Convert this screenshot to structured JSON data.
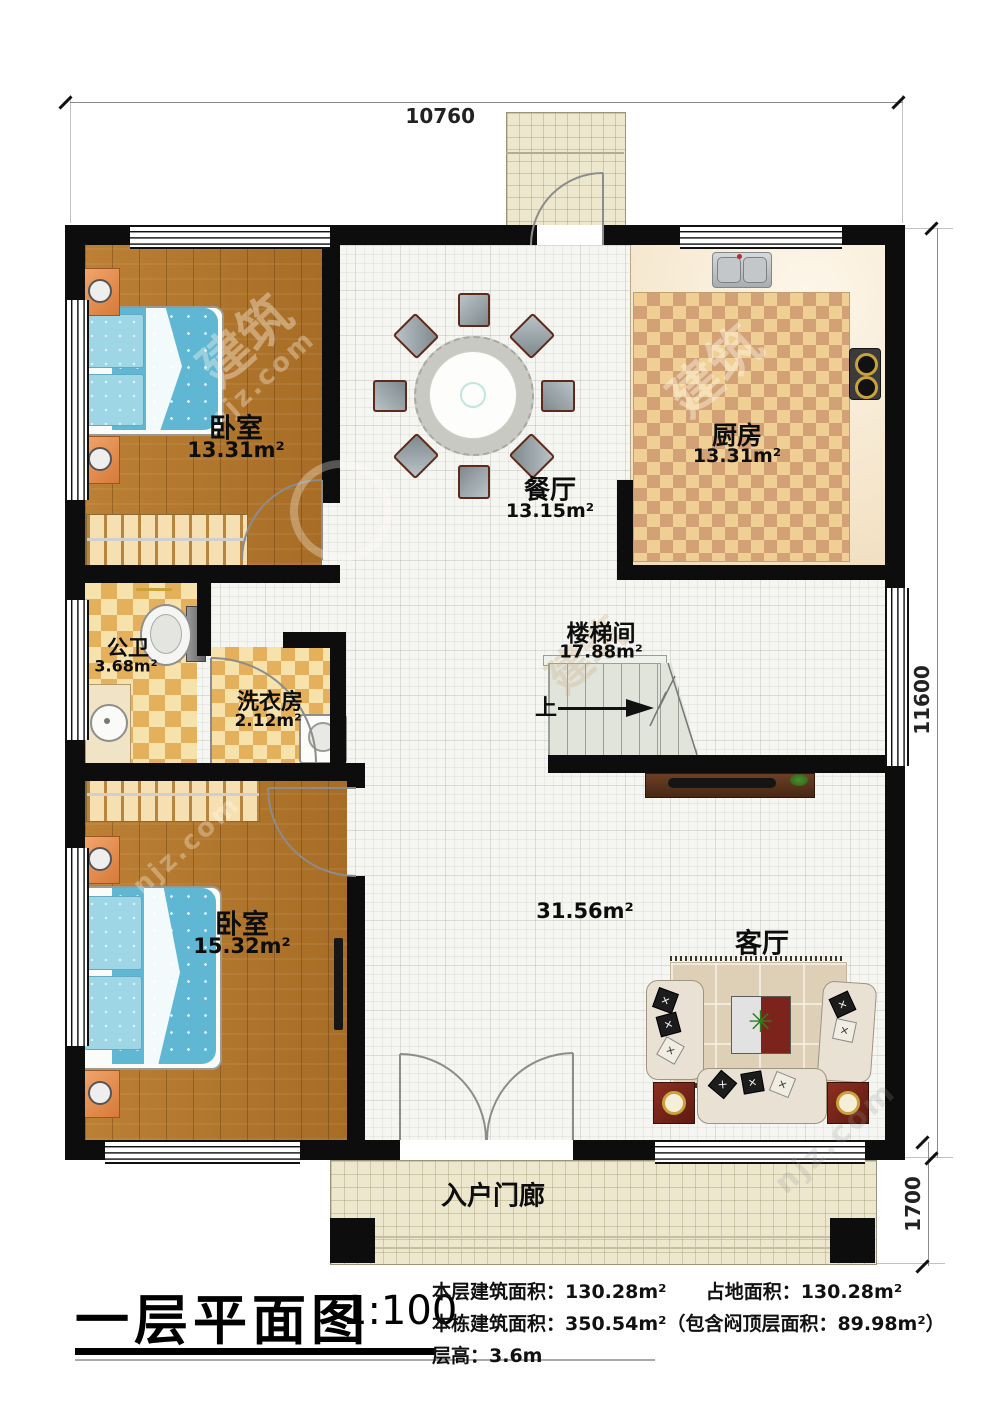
{
  "doc": {
    "title": "一层平面图",
    "scale": "1:100",
    "stats_line1_left": "本层建筑面积：130.28m²",
    "stats_line1_right": "占地面积：130.28m²",
    "stats_line2": "本栋建筑面积：350.54m²（包含闷顶层面积：89.98m²）",
    "stats_line3": "层高：3.6m"
  },
  "dimensions": {
    "top_width": "10760",
    "right_height": "11600",
    "porch_depth": "1700"
  },
  "rooms": {
    "bedroom1": {
      "label": "卧室",
      "area": "13.31m²"
    },
    "dining": {
      "label": "餐厅",
      "area": "13.15m²"
    },
    "kitchen": {
      "label": "厨房",
      "area": "13.31m²"
    },
    "bathroom": {
      "label": "公卫",
      "area": "3.68m²"
    },
    "laundry": {
      "label": "洗衣房",
      "area": "2.12m²"
    },
    "stairwell": {
      "label": "楼梯间",
      "area": "17.88m²",
      "up": "上"
    },
    "bedroom2": {
      "label": "卧室",
      "area": "15.32m²"
    },
    "living": {
      "label": "客厅",
      "area": "31.56m²"
    },
    "porch": {
      "label": "入户门廊"
    }
  },
  "watermark": {
    "cn": "建筑",
    "url": "njz.com"
  }
}
